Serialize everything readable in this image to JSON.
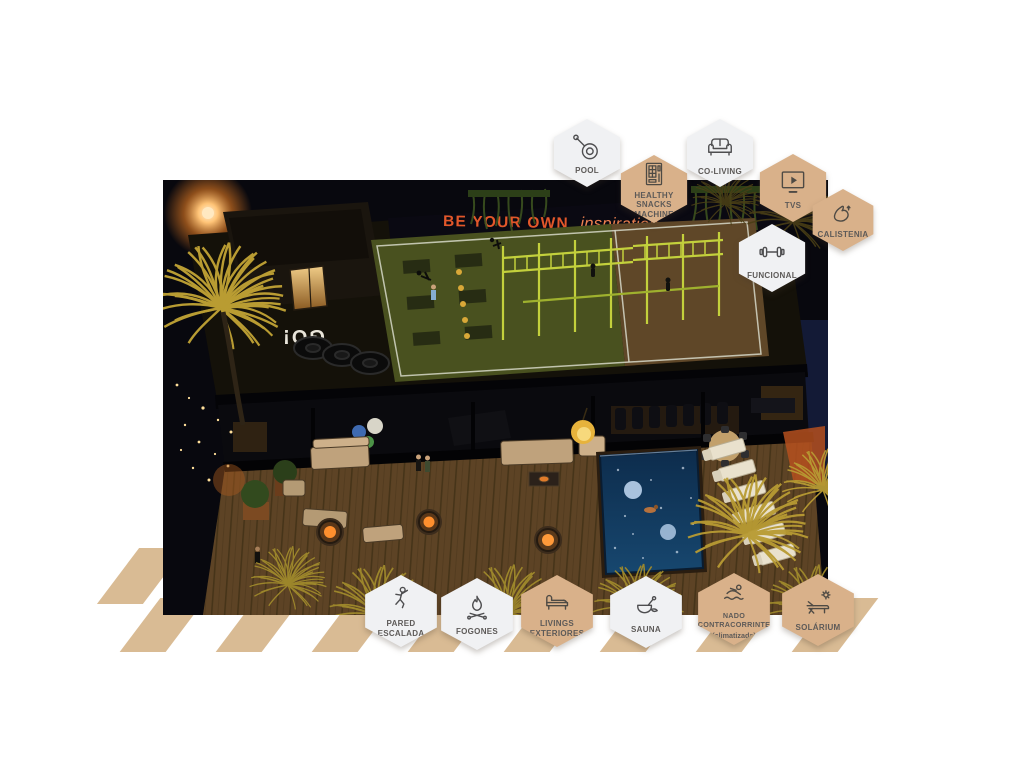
{
  "page": {
    "background": "#ffffff"
  },
  "scene": {
    "wall_slogan_bold": "BE YOUR OWN",
    "wall_slogan_script": "inspiration",
    "floor_text": "GO!"
  },
  "badges": {
    "top": [
      {
        "id": "pool",
        "label": "POOL",
        "icon": "pool-skimmer-icon",
        "variant": "light"
      },
      {
        "id": "healthy-snacks",
        "label": "HEALTHY SNACKS MACHINE",
        "icon": "vending-machine-icon",
        "variant": "tan"
      },
      {
        "id": "co-living",
        "label": "CO-LIVING",
        "icon": "sofa-icon",
        "variant": "light"
      },
      {
        "id": "tvs",
        "label": "TVS",
        "icon": "tv-icon",
        "variant": "tan"
      },
      {
        "id": "calistenia",
        "label": "CALISTENIA",
        "icon": "bicep-icon",
        "variant": "tan"
      },
      {
        "id": "funcional",
        "label": "FUNCIONAL",
        "icon": "dumbbell-icon",
        "variant": "light"
      }
    ],
    "bottom": [
      {
        "id": "pared-escalada",
        "label": "PARED ESCALADA",
        "icon": "climber-icon",
        "variant": "light"
      },
      {
        "id": "fogones",
        "label": "FOGONES",
        "icon": "campfire-icon",
        "variant": "light"
      },
      {
        "id": "livings-exteriores",
        "label": "LIVINGS EXTERIORES",
        "icon": "daybed-icon",
        "variant": "tan"
      },
      {
        "id": "sauna",
        "label": "SAUNA",
        "icon": "sauna-bucket-icon",
        "variant": "light"
      },
      {
        "id": "nado-contracorrinte",
        "label": "NADO CONTRACORRINTE",
        "sublabel": "(climatizada)",
        "icon": "swimmer-icon",
        "variant": "tan"
      },
      {
        "id": "solarium",
        "label": "SOLÁRIUM",
        "icon": "sun-lounger-icon",
        "variant": "tan"
      }
    ]
  },
  "colors": {
    "hex_tan": "#d9b18a",
    "hex_light": "#f0f1f3",
    "label_gray": "#5d5a58",
    "accent_orange": "#e2572a",
    "rig_yellow": "#c3d03c",
    "pool_blue": "#15446e",
    "stripe_tan": "#d9bb94"
  }
}
